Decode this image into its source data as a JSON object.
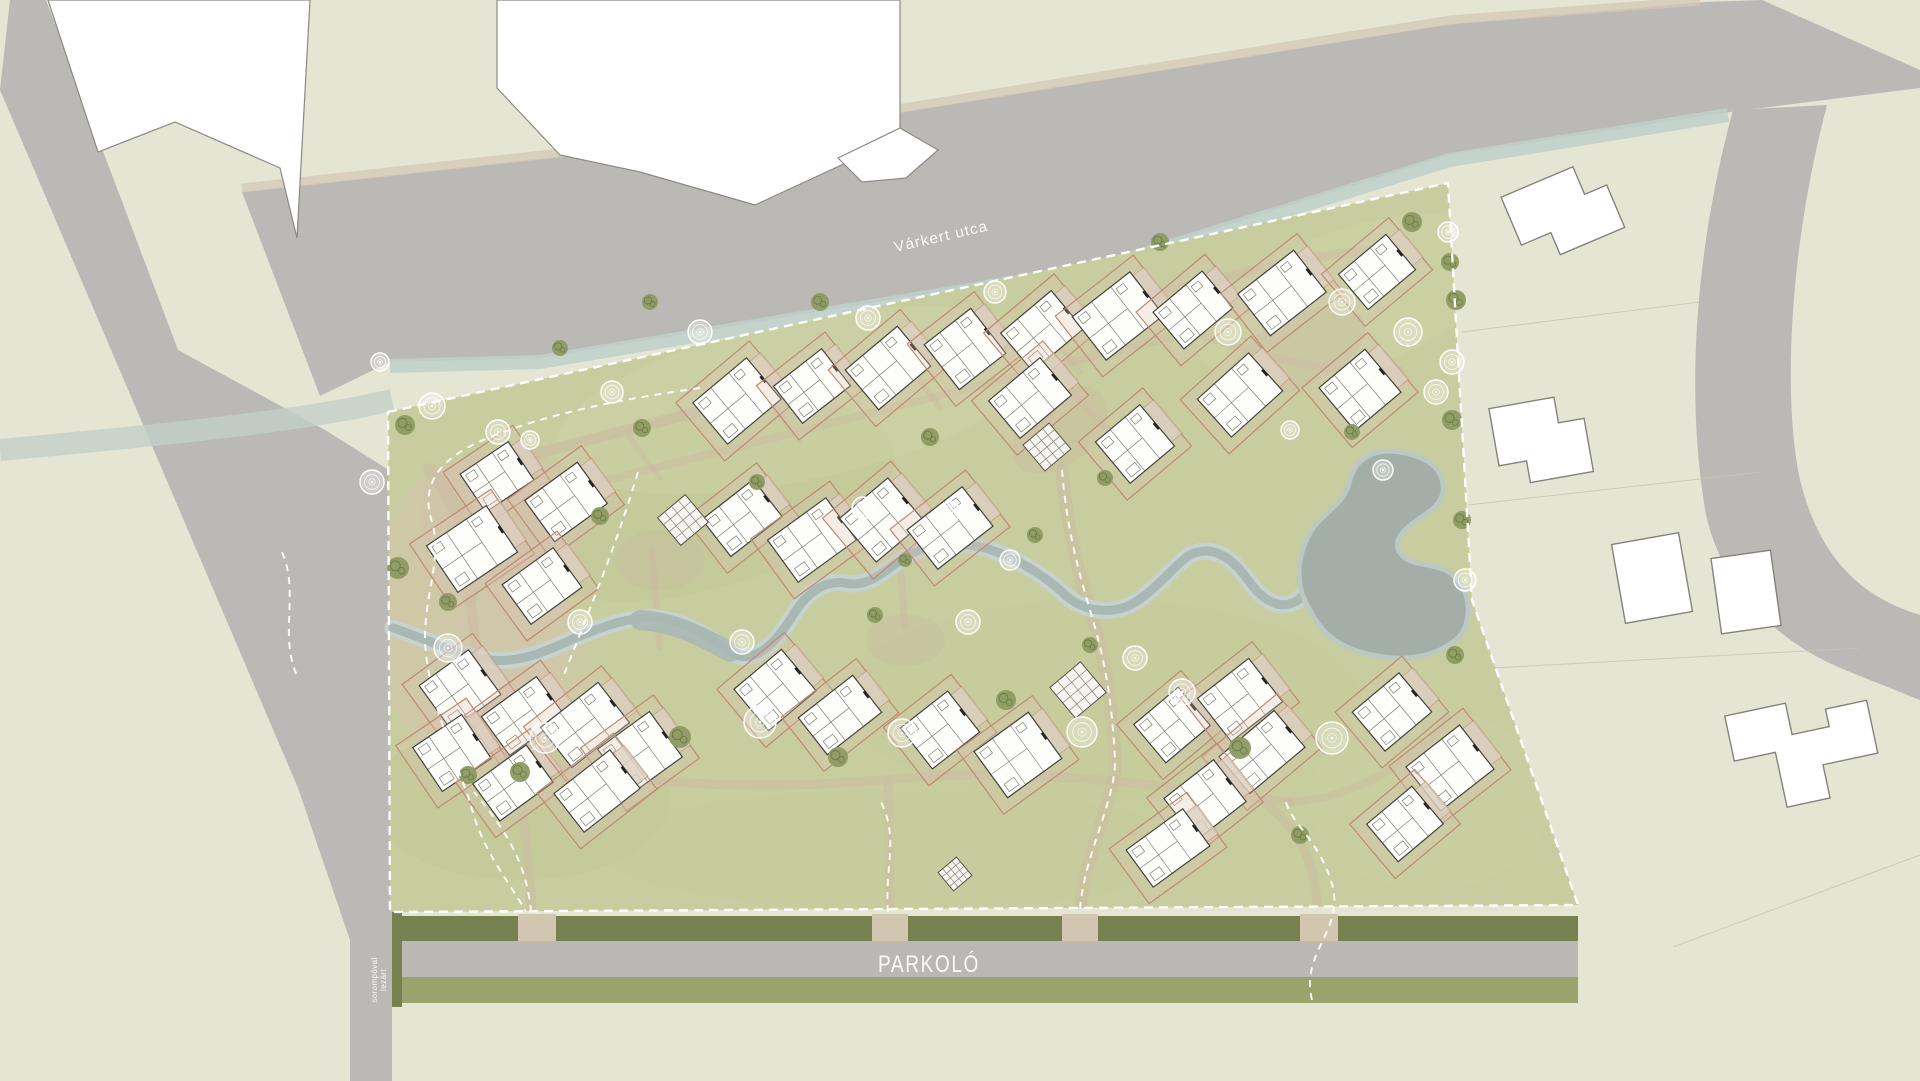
{
  "labels": {
    "street": "Várkert utca",
    "parking": "PARKOLÓ",
    "barrier_line1": "sorompóval",
    "barrier_line2": "lezárt"
  },
  "palette": {
    "paper": "#e4e5d3",
    "road": "#bab9b6",
    "site_green": "#c7cd9e",
    "hedge_dark": "#76814f",
    "verge_green": "#99a36b",
    "water_core": "#a9b8b2",
    "water_bank": "#c6d2cd",
    "pond": "#a3aea8",
    "path_tan": "#cbb9a2",
    "plot_line": "#c08a70",
    "tree_olive": "#8d9a62",
    "house_fill": "#fdfdfa",
    "house_line": "#43423e",
    "boundary": "#ffffff",
    "neighbor_fill": "#ffffff",
    "neighbor_line": "#83837b"
  },
  "houses": [
    [
      497,
      477,
      -34
    ],
    [
      566,
      502,
      -36
    ],
    [
      472,
      549,
      -34
    ],
    [
      542,
      586,
      -36
    ],
    [
      737,
      401,
      -40
    ],
    [
      812,
      386,
      -38
    ],
    [
      888,
      368,
      -40
    ],
    [
      965,
      349,
      -38
    ],
    [
      1042,
      331,
      -40
    ],
    [
      1118,
      316,
      -38
    ],
    [
      1193,
      310,
      -40
    ],
    [
      1282,
      293,
      -38
    ],
    [
      1377,
      272,
      -40
    ],
    [
      1240,
      395,
      -42
    ],
    [
      1360,
      390,
      -40
    ],
    [
      1030,
      398,
      -40
    ],
    [
      1135,
      444,
      -40
    ],
    [
      742,
      518,
      -38
    ],
    [
      812,
      540,
      -36
    ],
    [
      882,
      520,
      -40
    ],
    [
      950,
      528,
      -38
    ],
    [
      460,
      690,
      -36
    ],
    [
      523,
      716,
      -36
    ],
    [
      452,
      753,
      -34
    ],
    [
      513,
      783,
      -36
    ],
    [
      585,
      725,
      -38
    ],
    [
      640,
      753,
      -36
    ],
    [
      597,
      791,
      -38
    ],
    [
      775,
      690,
      -40
    ],
    [
      840,
      715,
      -38
    ],
    [
      940,
      730,
      -38
    ],
    [
      1018,
      755,
      -36
    ],
    [
      1172,
      725,
      -40
    ],
    [
      1240,
      700,
      -38
    ],
    [
      1262,
      752,
      -40
    ],
    [
      1205,
      800,
      -38
    ],
    [
      1168,
      848,
      -36
    ],
    [
      1392,
      712,
      -40
    ],
    [
      1450,
      768,
      -38
    ],
    [
      1405,
      824,
      -40
    ]
  ],
  "pavilions": [
    [
      683,
      520,
      -40,
      36
    ],
    [
      1047,
      447,
      -40,
      34
    ],
    [
      1078,
      690,
      -40,
      40
    ],
    [
      955,
      874,
      -40,
      24
    ]
  ],
  "trees": {
    "olive": [
      [
        405,
        425,
        10
      ],
      [
        398,
        568,
        11
      ],
      [
        448,
        602,
        9
      ],
      [
        520,
        772,
        10
      ],
      [
        680,
        737,
        11
      ],
      [
        838,
        757,
        10
      ],
      [
        1006,
        700,
        10
      ],
      [
        1240,
        748,
        11
      ],
      [
        642,
        428,
        9
      ],
      [
        600,
        516,
        9
      ],
      [
        757,
        482,
        8
      ],
      [
        930,
        437,
        9
      ],
      [
        820,
        302,
        9
      ],
      [
        650,
        302,
        8
      ],
      [
        1160,
        242,
        9
      ],
      [
        1412,
        222,
        10
      ],
      [
        1450,
        262,
        9
      ],
      [
        1456,
        300,
        10
      ],
      [
        1452,
        420,
        10
      ],
      [
        1352,
        432,
        8
      ],
      [
        875,
        615,
        8
      ],
      [
        1105,
        478,
        8
      ],
      [
        560,
        348,
        8
      ],
      [
        468,
        775,
        9
      ],
      [
        1300,
        835,
        9
      ],
      [
        1455,
        655,
        9
      ],
      [
        1090,
        645,
        8
      ],
      [
        1462,
        520,
        9
      ],
      [
        905,
        560,
        7
      ],
      [
        1035,
        535,
        8
      ]
    ],
    "white": [
      [
        432,
        406,
        13
      ],
      [
        372,
        482,
        12
      ],
      [
        448,
        648,
        14
      ],
      [
        545,
        738,
        15
      ],
      [
        760,
        722,
        16
      ],
      [
        902,
        733,
        14
      ],
      [
        1082,
        732,
        15
      ],
      [
        1332,
        738,
        16
      ],
      [
        1182,
        692,
        13
      ],
      [
        1408,
        332,
        14
      ],
      [
        1452,
        362,
        12
      ],
      [
        1436,
        392,
        12
      ],
      [
        868,
        318,
        12
      ],
      [
        700,
        332,
        12
      ],
      [
        498,
        432,
        12
      ],
      [
        1228,
        332,
        13
      ],
      [
        1342,
        302,
        13
      ],
      [
        742,
        642,
        12
      ],
      [
        580,
        622,
        12
      ],
      [
        968,
        622,
        12
      ],
      [
        1135,
        658,
        12
      ],
      [
        995,
        292,
        11
      ],
      [
        612,
        392,
        11
      ],
      [
        1383,
        470,
        10
      ],
      [
        1465,
        580,
        11
      ],
      [
        863,
        508,
        11
      ],
      [
        950,
        512,
        10
      ],
      [
        1010,
        560,
        10
      ],
      [
        380,
        362,
        9
      ],
      [
        530,
        440,
        9
      ],
      [
        1448,
        232,
        10
      ],
      [
        1290,
        430,
        9
      ]
    ]
  }
}
